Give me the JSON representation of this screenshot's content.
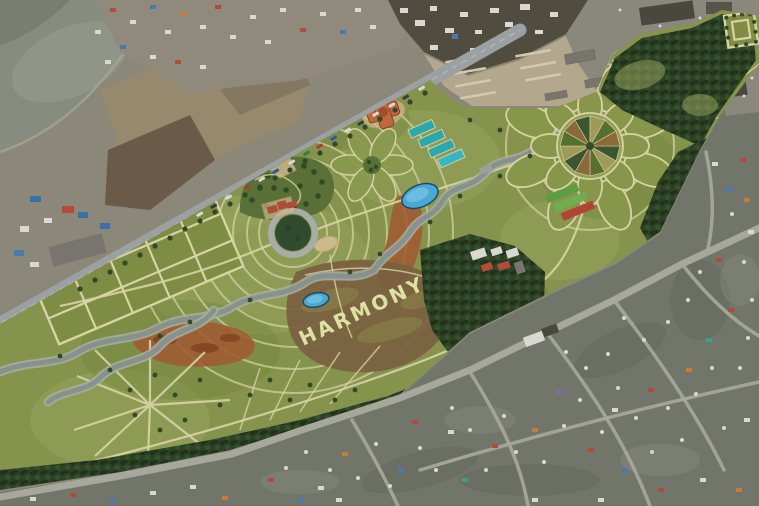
{
  "scene": {
    "type": "aerial-park-masterplan",
    "description": "Rendered master plan of a linear riverside park overlaid on satellite imagery of a ger district and industrial zone",
    "landscape_text": "HARMONY"
  },
  "palette": {
    "water": "#868d7f",
    "shore": "#a8a493",
    "ground": "#8b8779",
    "field-tan": "#97896d",
    "field-brown": "#6a5a47",
    "village-ground": "#8f8a7c",
    "industrial-dark": "#514c40",
    "gh-field": "#b3a78d",
    "gh-row": "#d2c9ae",
    "yard-gray": "#8a877c",
    "br-ground": "#72766a",
    "shade-dark": "#63665c",
    "road": "#9ba1a3",
    "road-line": "#c3c7c3",
    "dirt-road": "#aaa89c",
    "park-green": "#85934d",
    "park-light": "#95a35c",
    "park-dark": "#76883f",
    "path-tan": "#d8d3a4",
    "grid-field": "#7e8c44",
    "forest": "#2c4126",
    "forest-dark": "#1f3119",
    "forest-light": "#35522c",
    "tree": "#2e4a28",
    "stream": "#87928f",
    "stream-bank": "#a9afa0",
    "pond": "#49a9d4",
    "pond-deep": "#1f4a66",
    "pond-light": "#7cc4e4",
    "court-teal": "#2ba7ae",
    "court-blue": "#35b5c5",
    "roof-red": "#b14a36",
    "building-orange": "#c2673b",
    "sand": "#cdb98a",
    "rust": "#a05830",
    "rust-dark": "#7e431f",
    "harmony-field": "#7a6040",
    "harmony-text": "#dde2a2",
    "plaza-ring": "#a9ada8",
    "plaza-lawn": "#2f4c2e",
    "wood-garden": "#5a7036",
    "bed-green": "#5f9c42",
    "bed-green2": "#6fae4e",
    "bed-red": "#b24436",
    "house-white": "#d9d9d2",
    "house-red": "#b24c36",
    "house-orange": "#c67a3c",
    "house-blue": "#4a78b0",
    "house-teal": "#3aa092",
    "house-purple": "#8a68a8",
    "roof-dark": "#4a473e",
    "blue-roof": "#3d6fa8",
    "vehicle-dark": "#3a3a38",
    "warehouse-gray": "#77756d"
  }
}
